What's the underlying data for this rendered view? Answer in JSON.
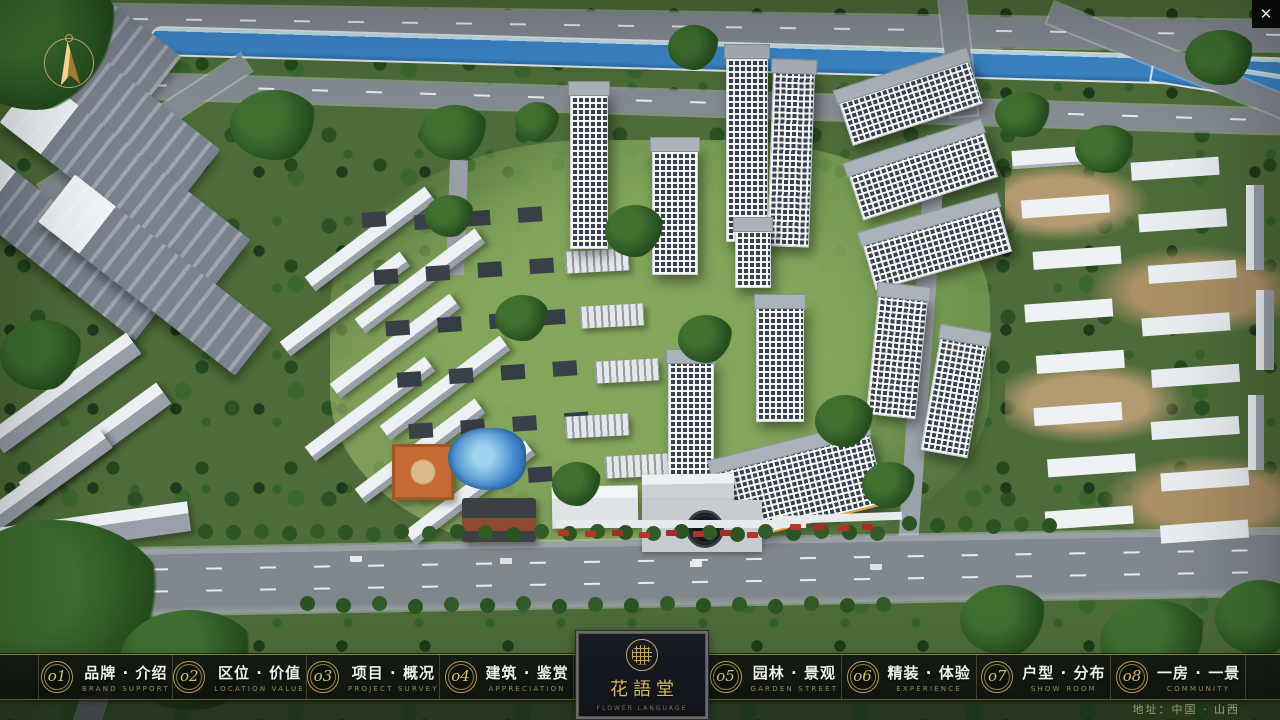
{
  "window": {
    "close_label": "✕"
  },
  "logo": {
    "title": "花語堂",
    "subtitle": "FLOWER LANGUAGE"
  },
  "menu": {
    "items": [
      {
        "num": "o1",
        "zh": "品牌 · 介绍",
        "en": "BRAND SUPPORT"
      },
      {
        "num": "o2",
        "zh": "区位 · 价值",
        "en": "LOCATION VALUE"
      },
      {
        "num": "o3",
        "zh": "项目 · 概况",
        "en": "PROJECT SURVEY"
      },
      {
        "num": "o4",
        "zh": "建筑 · 鉴赏",
        "en": "APPRECIATION"
      },
      {
        "num": "o5",
        "zh": "园林 · 景观",
        "en": "GARDEN STREET"
      },
      {
        "num": "o6",
        "zh": "精装 · 体验",
        "en": "EXPERIENCE"
      },
      {
        "num": "o7",
        "zh": "户型 · 分布",
        "en": "SHOW ROOM"
      },
      {
        "num": "o8",
        "zh": "一房 · 一景",
        "en": "COMMUNITY"
      }
    ]
  },
  "footer": {
    "address": "地址：中国 · 山西"
  },
  "colors": {
    "gold": "#c9a85e",
    "bar_bg": "#12160f",
    "river": "#3c86c8",
    "road": "#848b92"
  }
}
